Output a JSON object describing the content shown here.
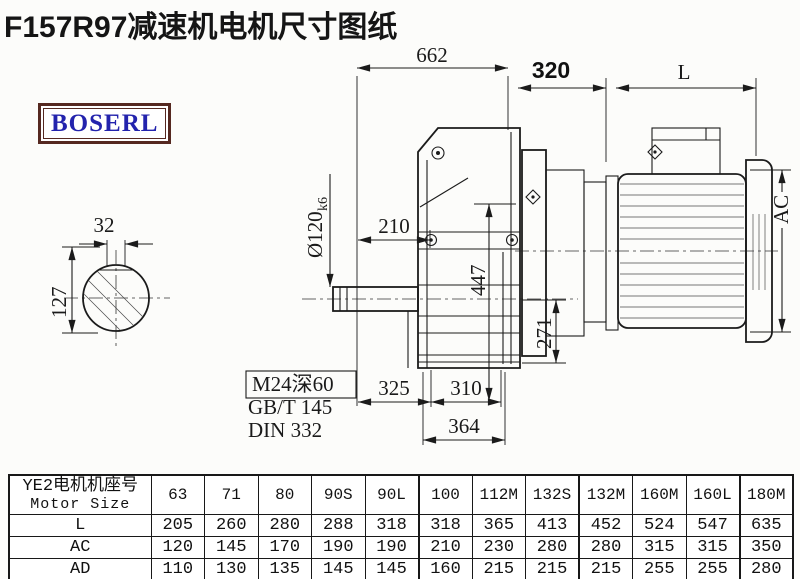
{
  "title": "F157R97减速机电机尺寸图纸",
  "logo": {
    "text": "BOSERL",
    "border_color": "#552820",
    "text_color": "#2323ad"
  },
  "drawing": {
    "dim_662": "662",
    "dim_320": "320",
    "dim_L": "L",
    "dim_AC": "AC",
    "dim_shaft_dia": "Ø120",
    "dim_shaft_tol": "k6",
    "dim_210": "210",
    "dim_447": "447",
    "dim_271": "271",
    "dim_325": "325",
    "dim_310": "310",
    "dim_364": "364",
    "dim_32": "32",
    "dim_127": "127",
    "note_thread": "M24深60",
    "note_std1": "GB/T 145",
    "note_std2": "DIN 332"
  },
  "table": {
    "header_cn": "YE2电机机座号",
    "header_en": "Motor Size",
    "columns": [
      "63",
      "71",
      "80",
      "90S",
      "90L",
      "100",
      "112M",
      "132S",
      "132M",
      "160M",
      "160L",
      "180M"
    ],
    "rows": [
      {
        "label": "L",
        "values": [
          "205",
          "260",
          "280",
          "288",
          "318",
          "318",
          "365",
          "413",
          "452",
          "524",
          "547",
          "635"
        ]
      },
      {
        "label": "AC",
        "values": [
          "120",
          "145",
          "170",
          "190",
          "190",
          "210",
          "230",
          "280",
          "280",
          "315",
          "315",
          "350"
        ]
      },
      {
        "label": "AD",
        "values": [
          "110",
          "130",
          "135",
          "145",
          "145",
          "160",
          "215",
          "215",
          "215",
          "255",
          "255",
          "280"
        ]
      }
    ],
    "bold_divider_before": [
      "100",
      "132M",
      "180M"
    ]
  }
}
